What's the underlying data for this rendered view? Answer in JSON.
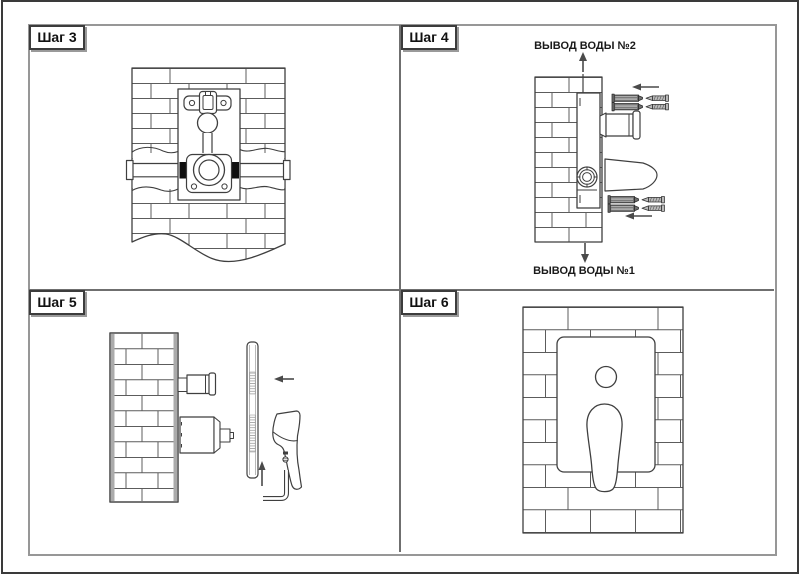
{
  "sheet": {
    "steps": [
      {
        "id": "step-3",
        "label": "Шаг 3"
      },
      {
        "id": "step-4",
        "label": "Шаг 4",
        "caption_top": "ВЫВОД  ВОДЫ №2",
        "caption_bottom": "ВЫВОД ВОДЫ №1"
      },
      {
        "id": "step-5",
        "label": "Шаг 5"
      },
      {
        "id": "step-6",
        "label": "Шаг 6"
      }
    ]
  },
  "icons": {
    "up-arrow-icon": "↑",
    "down-arrow-icon": "↓",
    "left-arrow-icon": "←",
    "brick-wall-icon": "▤",
    "wall-plug-icon": "▬",
    "screw-icon": "⟝",
    "allen-key-icon": "L",
    "lever-handle-icon": "◗",
    "escutcheon-plate-icon": "▯",
    "diverter-knob-icon": "○"
  },
  "colors": {
    "background": "#ffffff",
    "line": "#3f3f3f",
    "brick_line": "#5c5c5c",
    "outer_border": "#3a3a3a",
    "panel_border": "#979797",
    "divider": "#6f6f6f",
    "label_box_border": "#3c3c3c",
    "seal_fill": "#0f0f0f",
    "dowel_fill": "#6f6f6f",
    "metal_fill": "#bdbdbd",
    "wall_edge_shade": "#ababab"
  }
}
